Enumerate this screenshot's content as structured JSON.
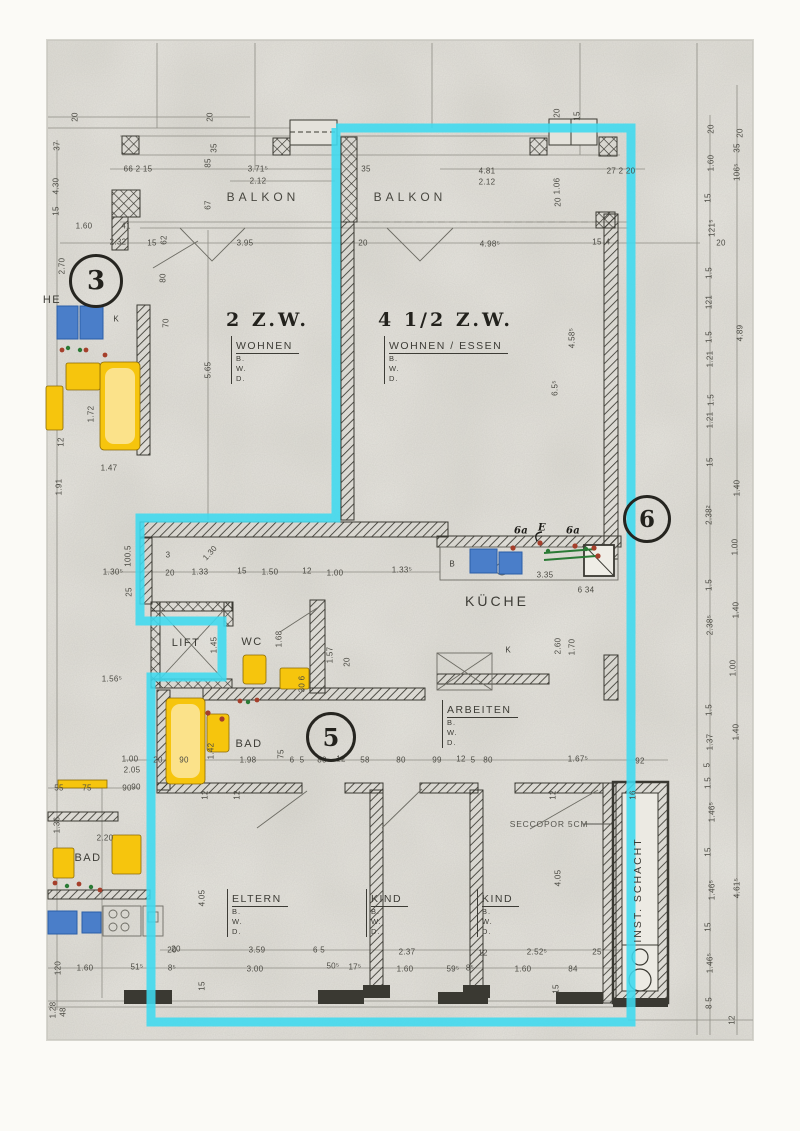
{
  "page": {
    "width": 800,
    "height": 1131,
    "description": "Scanned floor plan with apartment 4 1/2 Z.W. highlighted"
  },
  "colors": {
    "paper": "#dad8d1",
    "paper_light": "#e9e7e0",
    "margin": "#fbfaf6",
    "line": "#8e8d85",
    "dark": "#3a3932",
    "text": "#4b4a43",
    "cyan_highlight": "#3ed9ef",
    "fixture_yellow": "#f6c50d",
    "fixture_blue": "#4a7ec9",
    "wire_green": "#2a7a35",
    "dot_red": "#a53f2b"
  },
  "unit_titles": [
    {
      "t": "2  Z.W.",
      "x": 226,
      "y": 320
    },
    {
      "t": "4  1/2  Z.W.",
      "x": 378,
      "y": 320
    }
  ],
  "bwd_blocks": [
    {
      "title": "WOHNEN",
      "lines": [
        "B.",
        "W.",
        "D."
      ],
      "x": 231,
      "y": 336
    },
    {
      "title": "WOHNEN  /  ESSEN",
      "lines": [
        "B.",
        "W.",
        "D."
      ],
      "x": 384,
      "y": 336
    },
    {
      "title": "ARBEITEN",
      "lines": [
        "B.",
        "W.",
        "D."
      ],
      "x": 442,
      "y": 700
    },
    {
      "title": "ELTERN",
      "lines": [
        "B.",
        "W.",
        "D."
      ],
      "x": 227,
      "y": 889
    },
    {
      "title": "KIND",
      "lines": [
        "B.",
        "W.",
        "D."
      ],
      "x": 366,
      "y": 889
    },
    {
      "title": "KIND",
      "lines": [
        "B.",
        "W.",
        "D."
      ],
      "x": 477,
      "y": 889
    }
  ],
  "markers": [
    {
      "t": "3",
      "x": 96,
      "y": 281,
      "rsize": 24
    },
    {
      "t": "5",
      "x": 331,
      "y": 737,
      "rsize": 22
    },
    {
      "t": "6",
      "x": 647,
      "y": 519,
      "rsize": 21
    }
  ],
  "room_labels": [
    {
      "t": "BALKON",
      "x": 263,
      "y": 197,
      "cls": "balkon",
      "name": "room-label-balkon-left"
    },
    {
      "t": "BALKON",
      "x": 410,
      "y": 197,
      "cls": "balkon",
      "name": "room-label-balkon-right"
    },
    {
      "t": "KÜCHE",
      "x": 497,
      "y": 601,
      "cls": "kueche",
      "name": "room-label-kueche"
    },
    {
      "t": "LIFT",
      "x": 186,
      "y": 643,
      "cls": "med",
      "name": "room-label-lift"
    },
    {
      "t": "WC",
      "x": 252,
      "y": 642,
      "cls": "med",
      "name": "room-label-wc"
    },
    {
      "t": "BAD",
      "x": 249,
      "y": 744,
      "cls": "med",
      "name": "room-label-bad-unit5"
    },
    {
      "t": "BAD",
      "x": 88,
      "y": 858,
      "cls": "med",
      "name": "room-label-bad-left"
    },
    {
      "t": "HE",
      "x": 52,
      "y": 300,
      "cls": "med",
      "name": "room-label-fragment-he"
    },
    {
      "t": "K",
      "x": 116,
      "y": 319,
      "cls": "tiny2",
      "name": "closet-label-k-left"
    },
    {
      "t": "K",
      "x": 508,
      "y": 650,
      "cls": "tiny2",
      "name": "closet-label-k-kitchen"
    },
    {
      "t": "B",
      "x": 452,
      "y": 564,
      "cls": "tiny2",
      "name": "counter-label-b"
    },
    {
      "t": "SECCOPOR 5CM",
      "x": 549,
      "y": 824,
      "cls": "seccopor",
      "name": "annotation-seccopor"
    },
    {
      "t": "INST. SCHACHT",
      "x": 638,
      "y": 890,
      "cls": "schacht",
      "name": "room-label-inst-schacht"
    }
  ],
  "dims": [
    {
      "t": "20",
      "x": 75,
      "y": 117,
      "r": 1
    },
    {
      "t": "20",
      "x": 210,
      "y": 117,
      "r": 1
    },
    {
      "t": "37",
      "x": 57,
      "y": 146,
      "r": 1
    },
    {
      "t": "4.30",
      "x": 56,
      "y": 186,
      "r": 1
    },
    {
      "t": "15",
      "x": 56,
      "y": 211,
      "r": 1
    },
    {
      "t": "66 2 15",
      "x": 138,
      "y": 169
    },
    {
      "t": "3.71⁵",
      "x": 258,
      "y": 169
    },
    {
      "t": "2.12",
      "x": 258,
      "y": 181
    },
    {
      "t": "85",
      "x": 208,
      "y": 163,
      "r": 1
    },
    {
      "t": "67",
      "x": 208,
      "y": 205,
      "r": 1
    },
    {
      "t": "35",
      "x": 214,
      "y": 148,
      "r": 1
    },
    {
      "t": "1.60",
      "x": 84,
      "y": 226
    },
    {
      "t": "41",
      "x": 126,
      "y": 226
    },
    {
      "t": "2.32",
      "x": 118,
      "y": 242
    },
    {
      "t": "15",
      "x": 152,
      "y": 243
    },
    {
      "t": "62",
      "x": 164,
      "y": 240,
      "r": 1
    },
    {
      "t": "2.70",
      "x": 62,
      "y": 266,
      "r": 1
    },
    {
      "t": "3.95",
      "x": 245,
      "y": 243
    },
    {
      "t": "20",
      "x": 363,
      "y": 243
    },
    {
      "t": "35",
      "x": 366,
      "y": 169
    },
    {
      "t": "4.81",
      "x": 487,
      "y": 171
    },
    {
      "t": "2.12",
      "x": 487,
      "y": 182
    },
    {
      "t": "27 2 20",
      "x": 621,
      "y": 171
    },
    {
      "t": "4.98⁵",
      "x": 490,
      "y": 244
    },
    {
      "t": "15",
      "x": 597,
      "y": 242
    },
    {
      "t": "4",
      "x": 608,
      "y": 242
    },
    {
      "t": "20",
      "x": 557,
      "y": 113,
      "r": 1
    },
    {
      "t": "15",
      "x": 577,
      "y": 116,
      "r": 1
    },
    {
      "t": "80",
      "x": 163,
      "y": 278,
      "r": 1
    },
    {
      "t": "70",
      "x": 166,
      "y": 323,
      "r": 1
    },
    {
      "t": "5.65",
      "x": 208,
      "y": 370,
      "r": 1
    },
    {
      "t": "1.06",
      "x": 557,
      "y": 186,
      "r": 1
    },
    {
      "t": "20",
      "x": 558,
      "y": 202,
      "r": 1
    },
    {
      "t": "4.58⁵",
      "x": 572,
      "y": 338,
      "r": 1
    },
    {
      "t": "6.5⁵",
      "x": 555,
      "y": 388,
      "r": 1
    },
    {
      "t": "1.91",
      "x": 59,
      "y": 487,
      "r": 1
    },
    {
      "t": "1.72",
      "x": 91,
      "y": 414,
      "r": 1
    },
    {
      "t": "12",
      "x": 61,
      "y": 442,
      "r": 1
    },
    {
      "t": "1.47",
      "x": 109,
      "y": 468
    },
    {
      "t": "20",
      "x": 711,
      "y": 129,
      "r": 1
    },
    {
      "t": "20",
      "x": 740,
      "y": 133,
      "r": 1
    },
    {
      "t": "35",
      "x": 737,
      "y": 148,
      "r": 1
    },
    {
      "t": "1.60",
      "x": 711,
      "y": 163,
      "r": 1
    },
    {
      "t": "106⁵",
      "x": 737,
      "y": 172,
      "r": 1
    },
    {
      "t": "15",
      "x": 708,
      "y": 198,
      "r": 1
    },
    {
      "t": "121⁵",
      "x": 712,
      "y": 228,
      "r": 1
    },
    {
      "t": "1.5",
      "x": 709,
      "y": 273,
      "r": 1
    },
    {
      "t": "121",
      "x": 709,
      "y": 302,
      "r": 1
    },
    {
      "t": "4.89",
      "x": 740,
      "y": 333,
      "r": 1
    },
    {
      "t": "1.5",
      "x": 709,
      "y": 337,
      "r": 1
    },
    {
      "t": "1.21",
      "x": 710,
      "y": 359,
      "r": 1
    },
    {
      "t": "1.5",
      "x": 711,
      "y": 400,
      "r": 1
    },
    {
      "t": "1.21",
      "x": 710,
      "y": 420,
      "r": 1
    },
    {
      "t": "15",
      "x": 710,
      "y": 462,
      "r": 1
    },
    {
      "t": "1.40",
      "x": 737,
      "y": 488,
      "r": 1
    },
    {
      "t": "2.38²",
      "x": 709,
      "y": 515,
      "r": 1
    },
    {
      "t": "1.00",
      "x": 735,
      "y": 547,
      "r": 1
    },
    {
      "t": "1.5",
      "x": 709,
      "y": 585,
      "r": 1
    },
    {
      "t": "1.40",
      "x": 736,
      "y": 610,
      "r": 1
    },
    {
      "t": "2.38⁵",
      "x": 710,
      "y": 625,
      "r": 1
    },
    {
      "t": "1.00",
      "x": 733,
      "y": 668,
      "r": 1
    },
    {
      "t": "1.5",
      "x": 709,
      "y": 710,
      "r": 1
    },
    {
      "t": "1.40",
      "x": 736,
      "y": 732,
      "r": 1
    },
    {
      "t": "1.37",
      "x": 710,
      "y": 742,
      "r": 1
    },
    {
      "t": "5",
      "x": 707,
      "y": 765,
      "r": 1
    },
    {
      "t": "1.5",
      "x": 708,
      "y": 783,
      "r": 1
    },
    {
      "t": "1.46⁵",
      "x": 712,
      "y": 812,
      "r": 1
    },
    {
      "t": "15",
      "x": 708,
      "y": 852,
      "r": 1
    },
    {
      "t": "1.46⁵",
      "x": 712,
      "y": 890,
      "r": 1
    },
    {
      "t": "4.61⁵",
      "x": 737,
      "y": 888,
      "r": 1
    },
    {
      "t": "15",
      "x": 708,
      "y": 927,
      "r": 1
    },
    {
      "t": "1.46⁵",
      "x": 710,
      "y": 963,
      "r": 1
    },
    {
      "t": "8 5",
      "x": 709,
      "y": 1003,
      "r": 1
    },
    {
      "t": "12",
      "x": 732,
      "y": 1020,
      "r": 1
    },
    {
      "t": "20",
      "x": 721,
      "y": 243
    },
    {
      "t": "1.30⁵",
      "x": 113,
      "y": 572
    },
    {
      "t": "100.5",
      "x": 128,
      "y": 556,
      "r": 1
    },
    {
      "t": "25",
      "x": 129,
      "y": 592,
      "r": 1
    },
    {
      "t": "3",
      "x": 168,
      "y": 555
    },
    {
      "t": "1.30",
      "x": 210,
      "y": 553,
      "cls": "r45"
    },
    {
      "t": "20",
      "x": 170,
      "y": 573
    },
    {
      "t": "1.33",
      "x": 200,
      "y": 572
    },
    {
      "t": "15",
      "x": 242,
      "y": 571
    },
    {
      "t": "1.50",
      "x": 270,
      "y": 572
    },
    {
      "t": "12",
      "x": 307,
      "y": 571
    },
    {
      "t": "1.00",
      "x": 335,
      "y": 573
    },
    {
      "t": "1.33⁵",
      "x": 402,
      "y": 570
    },
    {
      "t": "3.35",
      "x": 545,
      "y": 575
    },
    {
      "t": "2.60",
      "x": 558,
      "y": 646,
      "r": 1
    },
    {
      "t": "1.70",
      "x": 572,
      "y": 647,
      "r": 1
    },
    {
      "t": "6 34",
      "x": 586,
      "y": 590
    },
    {
      "t": "6a",
      "x": 521,
      "y": 531,
      "cls": "hand"
    },
    {
      "t": "E",
      "x": 542,
      "y": 528,
      "cls": "hand"
    },
    {
      "t": "6a",
      "x": 573,
      "y": 531,
      "cls": "hand"
    },
    {
      "t": "1.45",
      "x": 214,
      "y": 645,
      "r": 1
    },
    {
      "t": "1.68",
      "x": 279,
      "y": 639,
      "r": 1
    },
    {
      "t": "1.57",
      "x": 330,
      "y": 655,
      "r": 1
    },
    {
      "t": "1.56⁵",
      "x": 112,
      "y": 679
    },
    {
      "t": "30 6",
      "x": 302,
      "y": 684,
      "r": 1
    },
    {
      "t": "20",
      "x": 347,
      "y": 662,
      "r": 1
    },
    {
      "t": "1.00",
      "x": 130,
      "y": 759
    },
    {
      "t": "2.05",
      "x": 132,
      "y": 770
    },
    {
      "t": "90",
      "x": 136,
      "y": 787
    },
    {
      "t": "20",
      "x": 158,
      "y": 760
    },
    {
      "t": "90",
      "x": 184,
      "y": 760
    },
    {
      "t": "1.98",
      "x": 248,
      "y": 760
    },
    {
      "t": "6",
      "x": 292,
      "y": 760
    },
    {
      "t": "5",
      "x": 302,
      "y": 760
    },
    {
      "t": "80",
      "x": 322,
      "y": 760
    },
    {
      "t": "12",
      "x": 341,
      "y": 759
    },
    {
      "t": "58",
      "x": 365,
      "y": 760
    },
    {
      "t": "80",
      "x": 401,
      "y": 760
    },
    {
      "t": "99",
      "x": 437,
      "y": 760
    },
    {
      "t": "12",
      "x": 461,
      "y": 759
    },
    {
      "t": "5",
      "x": 473,
      "y": 760
    },
    {
      "t": "80",
      "x": 488,
      "y": 760
    },
    {
      "t": "1.67⁵",
      "x": 578,
      "y": 759
    },
    {
      "t": "92",
      "x": 640,
      "y": 761
    },
    {
      "t": "1.42",
      "x": 211,
      "y": 751,
      "r": 1
    },
    {
      "t": "75",
      "x": 281,
      "y": 754,
      "r": 1
    },
    {
      "t": "55",
      "x": 59,
      "y": 788
    },
    {
      "t": "75",
      "x": 87,
      "y": 788
    },
    {
      "t": "90",
      "x": 127,
      "y": 788
    },
    {
      "t": "12",
      "x": 205,
      "y": 795,
      "r": 1
    },
    {
      "t": "2.20",
      "x": 105,
      "y": 838
    },
    {
      "t": "1.36",
      "x": 57,
      "y": 825,
      "r": 1
    },
    {
      "t": "120",
      "x": 58,
      "y": 968,
      "r": 1
    },
    {
      "t": "1.60",
      "x": 85,
      "y": 968
    },
    {
      "t": "51⁵",
      "x": 137,
      "y": 967
    },
    {
      "t": "8⁵",
      "x": 172,
      "y": 968
    },
    {
      "t": "20",
      "x": 172,
      "y": 950
    },
    {
      "t": "1.28",
      "x": 53,
      "y": 1010,
      "r": 1
    },
    {
      "t": "48",
      "x": 63,
      "y": 1012,
      "r": 1
    },
    {
      "t": "4.05",
      "x": 202,
      "y": 898,
      "r": 1
    },
    {
      "t": "12",
      "x": 237,
      "y": 795,
      "r": 1
    },
    {
      "t": "3.59",
      "x": 257,
      "y": 950
    },
    {
      "t": "3.00",
      "x": 255,
      "y": 969
    },
    {
      "t": "20",
      "x": 176,
      "y": 949
    },
    {
      "t": "15",
      "x": 202,
      "y": 986,
      "r": 1
    },
    {
      "t": "6 5",
      "x": 319,
      "y": 950
    },
    {
      "t": "50⁵",
      "x": 333,
      "y": 966
    },
    {
      "t": "17⁵",
      "x": 355,
      "y": 967
    },
    {
      "t": "2.37",
      "x": 407,
      "y": 952
    },
    {
      "t": "12",
      "x": 483,
      "y": 953
    },
    {
      "t": "2.52⁵",
      "x": 537,
      "y": 952
    },
    {
      "t": "25",
      "x": 597,
      "y": 952
    },
    {
      "t": "1.60",
      "x": 405,
      "y": 969
    },
    {
      "t": "59⁵",
      "x": 453,
      "y": 969
    },
    {
      "t": "8⁵",
      "x": 470,
      "y": 968
    },
    {
      "t": "1.60",
      "x": 523,
      "y": 969
    },
    {
      "t": "84",
      "x": 573,
      "y": 969
    },
    {
      "t": "15",
      "x": 556,
      "y": 989,
      "r": 1
    },
    {
      "t": "4.05",
      "x": 558,
      "y": 878,
      "r": 1
    },
    {
      "t": "12",
      "x": 553,
      "y": 795,
      "r": 1
    },
    {
      "t": "16",
      "x": 633,
      "y": 795,
      "r": 1
    }
  ]
}
